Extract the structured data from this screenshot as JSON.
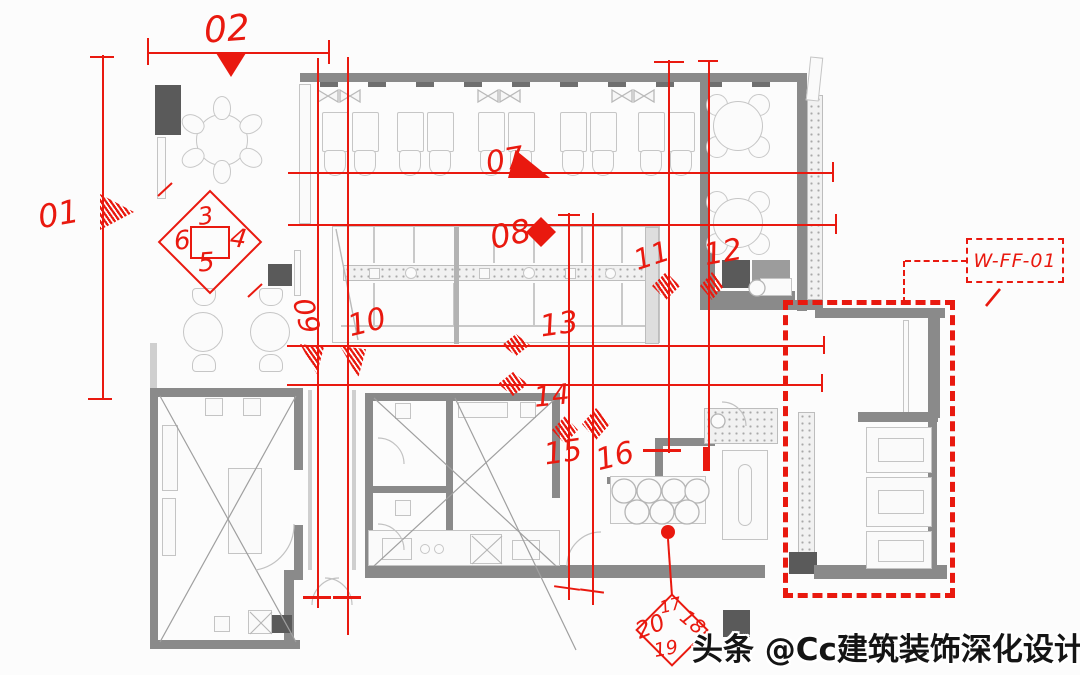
{
  "colors": {
    "annotation_red": "#e9190f",
    "wall_gray": "#8a8a8a",
    "dark_fixture": "#5a5a5a",
    "furniture_line": "#c6c6c6"
  },
  "annotations": {
    "a01": "01",
    "a02": "02",
    "a07": "07",
    "a08": "08",
    "a09": "09",
    "a10": "10",
    "a11": "11",
    "a12": "12",
    "a13": "13",
    "a14": "14",
    "a15": "15",
    "a16": "16"
  },
  "marker_top": {
    "n_top": "3",
    "n_left": "6",
    "n_right": "4",
    "n_bottom": "5"
  },
  "marker_bottom": {
    "n_top": "17",
    "n_left": "20",
    "n_right": "18",
    "n_bottom": "19"
  },
  "detail_tag": {
    "label": "W-FF-01"
  },
  "watermark": {
    "text": "头条 @Cc建筑装饰深化设计"
  }
}
